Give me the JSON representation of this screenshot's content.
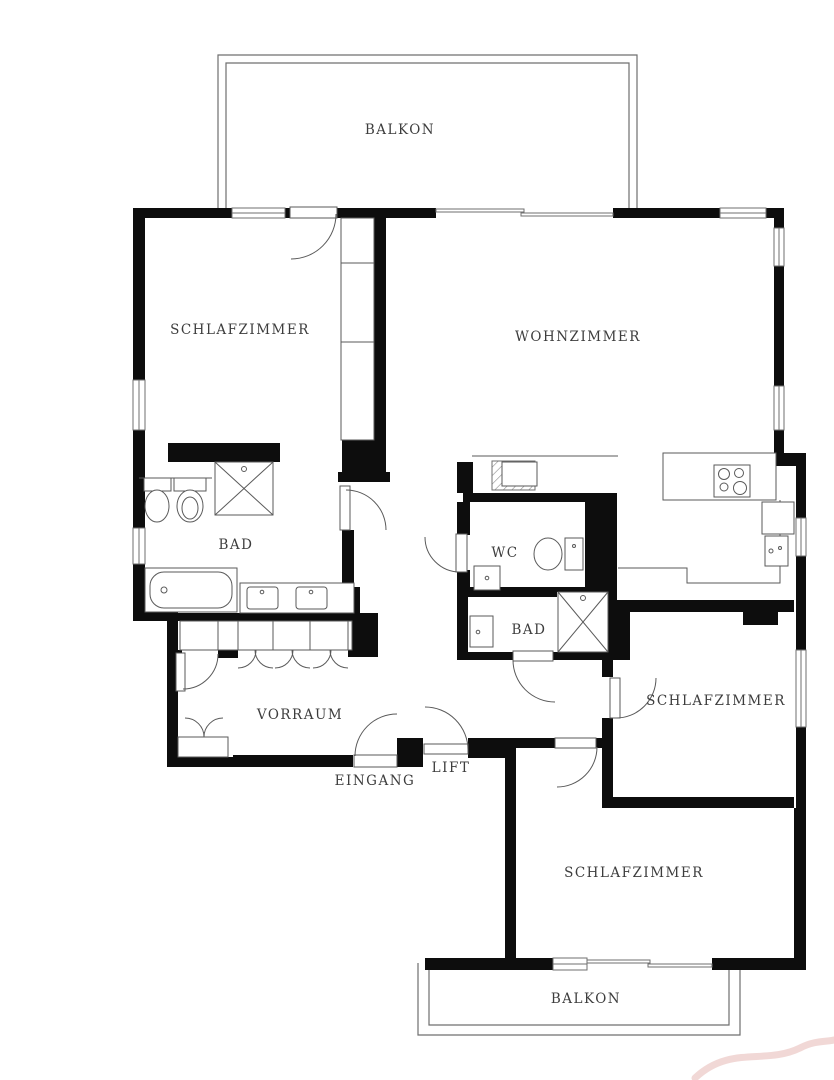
{
  "colors": {
    "wall": "#0d0d0d",
    "line": "#6f6f6f",
    "fixture": "#5a5a5a",
    "label": "#3d3d3d",
    "watermark": "#dfa8a3",
    "background": "#ffffff"
  },
  "rooms": {
    "balkon_top": {
      "label": "BALKON"
    },
    "schlafzimmer_nw": {
      "label": "SCHLAFZIMMER"
    },
    "wohnzimmer": {
      "label": "WOHNZIMMER"
    },
    "bad_main": {
      "label": "BAD"
    },
    "wc": {
      "label": "WC"
    },
    "bad_small": {
      "label": "BAD"
    },
    "vorraum": {
      "label": "VORRAUM"
    },
    "eingang": {
      "label": "EINGANG"
    },
    "lift": {
      "label": "LIFT"
    },
    "schlafzimmer_ost": {
      "label": "SCHLAFZIMMER"
    },
    "schlafzimmer_sued": {
      "label": "SCHLAFZIMMER"
    },
    "balkon_unten": {
      "label": "BALKON"
    }
  }
}
